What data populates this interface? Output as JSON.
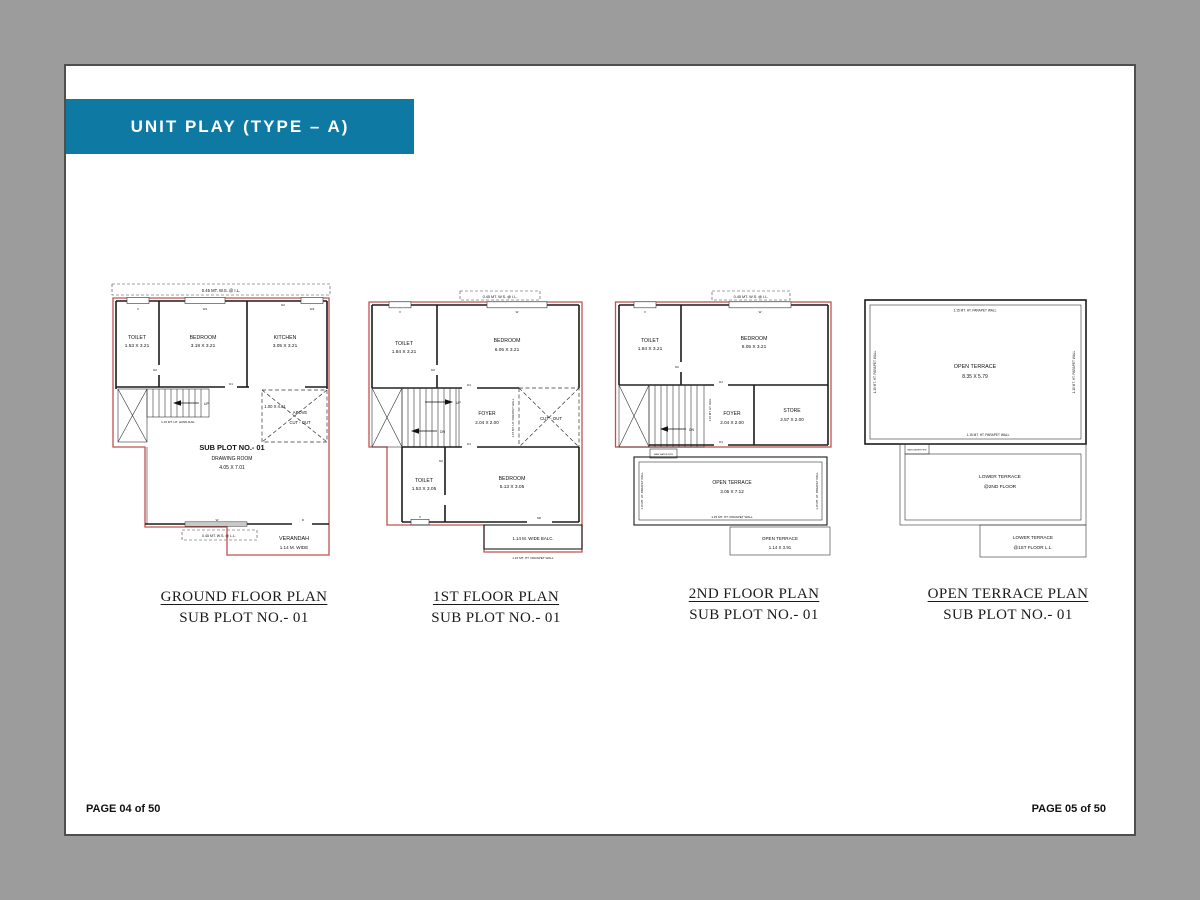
{
  "colors": {
    "canvas_bg": "#9c9c9c",
    "page_bg": "#ffffff",
    "page_border": "#4e4e4e",
    "banner_bg": "#0e79a3",
    "banner_text": "#ffffff",
    "plan_outline_red": "#c0504d",
    "wall_black": "#1b1b1b"
  },
  "header": {
    "title": "UNIT PLAY (TYPE – A)"
  },
  "footer": {
    "left": "PAGE 04 of 50",
    "right": "PAGE 05 of 50"
  },
  "plans": {
    "ground": {
      "title": "GROUND FLOOR PLAN",
      "subtitle": "SUB PLOT  NO.- 01",
      "sill_top": "0.45 MT. W.S. @ I.L.",
      "toilet": "TOILET",
      "toilet_dim": "1.53 X 3.21",
      "bedroom": "BEDROOM",
      "bedroom_dim": "3.19 X 3.21",
      "kitchen": "KITCHEN",
      "kitchen_dim": "3.05 X 3.21",
      "handrail": "1.15 MT. HT. HAND RAIL",
      "up": "UP",
      "cutout_dim": "1.00 X 4.61",
      "cutout_line1": "ABOVE",
      "cutout_line2": "CUT - OUT",
      "subplot": "SUB PLOT NO.- 01",
      "room": "DRAWING ROOM",
      "room_dim": "4.05 X 7.01",
      "sill_bottom": "0.45 MT. W.S. @ L.L.",
      "verandah": "VERANDAH",
      "verandah_dim": "1.14 M. WIDE",
      "tags": {
        "v": "V",
        "w1": "W1",
        "w2": "W2",
        "d2": "D2",
        "d1": "D1",
        "w": "W",
        "d": "D"
      }
    },
    "first": {
      "title": "1ST FLOOR PLAN",
      "subtitle": "SUB PLOT  NO.- 01",
      "sill_top": "0.45 MT. W.S. @ I.L.",
      "toilet": "TOILET",
      "toilet_dim": "1.84 X 3.21",
      "bedroom": "BEDROOM",
      "bedroom_dim": "6.05 X 3.21",
      "up": "UP",
      "dn": "DN",
      "foyer": "FOYER",
      "foyer_dim": "2.04 X 2.00",
      "parapet_mid": "1.15 MT. HT. PARAPET WALL",
      "cutout": "CUT - OUT",
      "toilet2": "TOILET",
      "toilet2_dim": "1.53 X 3.05",
      "bedroom2": "BEDROOM",
      "bedroom2_dim": "5.13 X 3.05",
      "balcony": "1.14 M. WIDE BALC.",
      "parapet_bottom": "1.15 MT. HT. PARAPET WALL",
      "tags": {
        "v": "V",
        "w": "W",
        "d1_top": "D1",
        "d1_low": "D1",
        "d2_top": "D2",
        "d2_low": "D2",
        "sd": "SD"
      }
    },
    "second": {
      "title": "2ND FLOOR PLAN",
      "subtitle": "SUB PLOT  NO.- 01",
      "sill_top": "0.45 MT. W.S. @ I.L.",
      "toilet": "TOILET",
      "toilet_dim": "1.84 X 3.21",
      "bedroom": "BEDROOM",
      "bedroom_dim": "6.05 X 3.21",
      "dn": "DN",
      "rail": "1.15 MT. HT. RAIL",
      "foyer": "FOYER",
      "foyer_dim": "2.04 X 2.00",
      "store": "STORE",
      "store_dim": "2.57 X 2.00",
      "terrace": "OPEN TERRACE",
      "terrace_dim": "3.05 X 7.12",
      "parapet_left": "1.15 MT. HT. PARAPET WALL",
      "parapet_right": "1.15 MT. HT. PARAPET WALL",
      "parapet_bottom": "1.15 MT. HT. PARAPET WALL",
      "rain_pipe": "RAIN WATER PIPE",
      "terrace2": "OPEN TERRACE",
      "terrace2_dim": "1.14 X 3.91",
      "tags": {
        "v": "V",
        "w": "W",
        "d1_top": "D1",
        "d1_low": "D1",
        "d2": "D2"
      }
    },
    "terrace": {
      "title": "OPEN TERRACE PLAN",
      "subtitle": "SUB PLOT  NO.- 01",
      "parapet_top": "1.15 MT. HT. PARAPET WALL",
      "parapet_left": "1.15 MT. HT. PARAPET WALL",
      "parapet_right": "1.15 MT. HT. PARAPET WALL",
      "parapet_bottom": "1.15 MT. HT. PARAPET WALL",
      "terrace": "OPEN TERRACE",
      "terrace_dim": "8.35 X 5.79",
      "rain_pipe": "RAIN WATER PIPE",
      "lower1": "LOWER TERRACE",
      "lower1_sub": "@2ND FLOOR",
      "lower2": "LOWER TERRACE",
      "lower2_sub": "@1ST FLOOR L.L."
    }
  }
}
